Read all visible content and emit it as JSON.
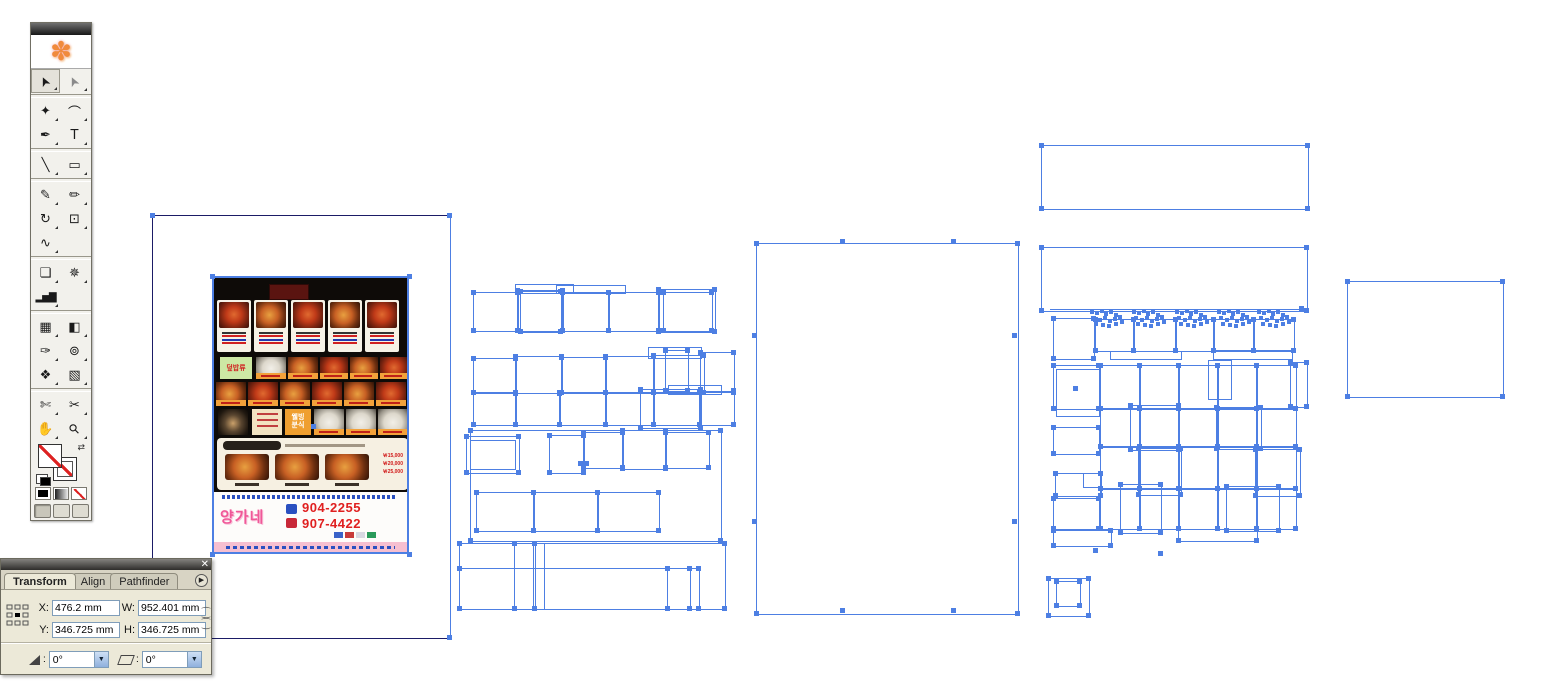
{
  "colors": {
    "selection": "#4d7fe3",
    "artboard_line": "#1b1b66"
  },
  "toolbar": {
    "tools": [
      {
        "name": "selection-tool",
        "glyph": "➤"
      },
      {
        "name": "direct-selection-tool",
        "glyph": "➤"
      },
      {
        "name": "magic-wand-tool",
        "glyph": "✦"
      },
      {
        "name": "lasso-tool",
        "glyph": "⌒"
      },
      {
        "name": "pen-tool",
        "glyph": "✒"
      },
      {
        "name": "type-tool",
        "glyph": "T"
      },
      {
        "name": "line-segment-tool",
        "glyph": "╲"
      },
      {
        "name": "rectangle-tool",
        "glyph": "▭"
      },
      {
        "name": "paintbrush-tool",
        "glyph": "✎"
      },
      {
        "name": "pencil-tool",
        "glyph": "✏"
      },
      {
        "name": "rotate-tool",
        "glyph": "↻"
      },
      {
        "name": "scale-tool",
        "glyph": "⊡"
      },
      {
        "name": "warp-tool",
        "glyph": "∿"
      },
      {
        "name": "free-transform-tool",
        "glyph": "❏"
      },
      {
        "name": "symbol-sprayer-tool",
        "glyph": "✵"
      },
      {
        "name": "graph-tool",
        "glyph": "▂▅▇"
      },
      {
        "name": "mesh-tool",
        "glyph": "▦"
      },
      {
        "name": "gradient-tool",
        "glyph": "◧"
      },
      {
        "name": "eyedropper-tool",
        "glyph": "✑"
      },
      {
        "name": "blend-tool",
        "glyph": "⊚"
      },
      {
        "name": "live-paint-bucket-tool",
        "glyph": "❖"
      },
      {
        "name": "live-paint-selection-tool",
        "glyph": "▧"
      },
      {
        "name": "slice-tool",
        "glyph": "✄"
      },
      {
        "name": "scissors-tool",
        "glyph": "✂"
      },
      {
        "name": "hand-tool",
        "glyph": "✋"
      },
      {
        "name": "zoom-tool",
        "glyph": "⚲"
      }
    ]
  },
  "transform_panel": {
    "tabs": [
      {
        "label": "Transform"
      },
      {
        "label": "Align"
      },
      {
        "label": "Pathfinder"
      }
    ],
    "active_tab": "Transform",
    "close_glyph": "✕",
    "menu_glyph": "▶",
    "fields": {
      "x_label": "X:",
      "x_value": "476.2 mm",
      "y_label": "Y:",
      "y_value": "346.725 mm",
      "w_label": "W:",
      "w_value": "952.401 mm",
      "h_label": "H:",
      "h_value": "346.725 mm"
    },
    "rotate_value": "0°",
    "shear_value": "0°",
    "dropdown_glyph": "▼"
  },
  "menu_flyer": {
    "category_label": "덮밥류",
    "wellbeing_line1": "웰빙",
    "wellbeing_line2": "분식",
    "brand": "양가네",
    "phone1": "904-2255",
    "phone2": "907-4422",
    "prices": [
      "￦15,000",
      "￦20,000",
      "￦25,000"
    ]
  },
  "selection": {
    "artboard": {
      "x": 152,
      "y": 215,
      "w": 297,
      "h": 422
    },
    "image": {
      "x": 212,
      "y": 276,
      "w": 197,
      "h": 278
    },
    "groups": {
      "center": [
        [
          473,
          292,
          44,
          38
        ],
        [
          517,
          290,
          45,
          40
        ],
        [
          562,
          292,
          46,
          38
        ],
        [
          608,
          292,
          50,
          38
        ],
        [
          658,
          289,
          56,
          42
        ],
        [
          520,
          291,
          40,
          40
        ],
        [
          663,
          292,
          48,
          38
        ],
        [
          515,
          284,
          57,
          8,
          0
        ],
        [
          556,
          285,
          68,
          7,
          0
        ],
        [
          473,
          358,
          42,
          34
        ],
        [
          515,
          356,
          46,
          36
        ],
        [
          561,
          357,
          44,
          35
        ],
        [
          605,
          356,
          48,
          36
        ],
        [
          653,
          355,
          50,
          37
        ],
        [
          665,
          350,
          22,
          40
        ],
        [
          700,
          352,
          33,
          38
        ],
        [
          668,
          385,
          52,
          8,
          0
        ],
        [
          648,
          347,
          52,
          10,
          0
        ],
        [
          473,
          392,
          42,
          32
        ],
        [
          515,
          393,
          44,
          31
        ],
        [
          559,
          392,
          46,
          32
        ],
        [
          605,
          392,
          48,
          32
        ],
        [
          653,
          392,
          46,
          32
        ],
        [
          699,
          392,
          34,
          32
        ],
        [
          640,
          389,
          60,
          38
        ],
        [
          466,
          436,
          52,
          36
        ],
        [
          470,
          440,
          44,
          28,
          0
        ],
        [
          549,
          435,
          34,
          37
        ],
        [
          583,
          432,
          39,
          35
        ],
        [
          622,
          430,
          43,
          38
        ],
        [
          665,
          432,
          43,
          35
        ],
        [
          470,
          430,
          250,
          110
        ],
        [
          476,
          492,
          57,
          38
        ],
        [
          533,
          492,
          64,
          38
        ],
        [
          597,
          492,
          61,
          38
        ],
        [
          459,
          543,
          265,
          65
        ],
        [
          514,
          543,
          20,
          65
        ],
        [
          533,
          543,
          10,
          65,
          0
        ],
        [
          459,
          568,
          239,
          40
        ],
        [
          667,
          568,
          22,
          40
        ]
      ],
      "big": [
        [
          756,
          243,
          261,
          370
        ]
      ],
      "top_right": [
        [
          1041,
          145,
          266,
          63
        ],
        [
          1041,
          247,
          265,
          63
        ]
      ],
      "right_grid": [
        [
          1053,
          318,
          40,
          40
        ],
        [
          1053,
          365,
          45,
          43
        ],
        [
          1056,
          369,
          42,
          46,
          0
        ],
        [
          1053,
          427,
          45,
          26
        ],
        [
          1055,
          473,
          45,
          22
        ],
        [
          1083,
          473,
          17,
          13,
          0
        ],
        [
          1053,
          498,
          45,
          30
        ],
        [
          1053,
          530,
          57,
          15
        ],
        [
          1095,
          319,
          38,
          31
        ],
        [
          1133,
          319,
          42,
          31
        ],
        [
          1175,
          319,
          38,
          31
        ],
        [
          1213,
          319,
          40,
          31
        ],
        [
          1253,
          319,
          40,
          31
        ],
        [
          1110,
          351,
          70,
          7,
          0
        ],
        [
          1213,
          350,
          78,
          8,
          0
        ],
        [
          1100,
          365,
          39,
          43
        ],
        [
          1139,
          365,
          39,
          43
        ],
        [
          1178,
          365,
          39,
          43
        ],
        [
          1217,
          365,
          39,
          43
        ],
        [
          1256,
          365,
          39,
          43
        ],
        [
          1100,
          408,
          39,
          38
        ],
        [
          1139,
          408,
          39,
          38
        ],
        [
          1178,
          408,
          39,
          38
        ],
        [
          1217,
          408,
          39,
          38
        ],
        [
          1256,
          408,
          39,
          38
        ],
        [
          1100,
          446,
          39,
          42
        ],
        [
          1139,
          446,
          39,
          42
        ],
        [
          1178,
          446,
          39,
          42
        ],
        [
          1217,
          446,
          39,
          42
        ],
        [
          1256,
          446,
          39,
          42
        ],
        [
          1100,
          488,
          39,
          40
        ],
        [
          1139,
          488,
          39,
          40
        ],
        [
          1178,
          488,
          39,
          40
        ],
        [
          1217,
          488,
          39,
          40
        ],
        [
          1256,
          488,
          39,
          40
        ],
        [
          1208,
          360,
          22,
          38,
          0
        ],
        [
          1290,
          362,
          16,
          44
        ],
        [
          1130,
          405,
          48,
          44
        ],
        [
          1216,
          407,
          44,
          41
        ],
        [
          1138,
          448,
          42,
          46
        ],
        [
          1255,
          449,
          44,
          46
        ],
        [
          1226,
          486,
          52,
          44
        ],
        [
          1120,
          484,
          40,
          48
        ],
        [
          1178,
          488,
          78,
          52
        ]
      ],
      "far_right": [
        [
          1347,
          281,
          155,
          115
        ]
      ],
      "small_pair": [
        [
          1048,
          578,
          40,
          37
        ],
        [
          1056,
          581,
          23,
          24
        ]
      ]
    },
    "lines": [
      [
        1050,
        309,
        253
      ]
    ],
    "blobs": [
      [
        1090,
        310
      ],
      [
        1132,
        310
      ],
      [
        1175,
        310
      ],
      [
        1217,
        310
      ],
      [
        1257,
        310
      ]
    ],
    "extra_handles": [
      [
        313,
        426
      ],
      [
        580,
        463
      ],
      [
        586,
        463
      ],
      [
        1075,
        388
      ],
      [
        842,
        241
      ],
      [
        953,
        241
      ],
      [
        754,
        335
      ],
      [
        754,
        521
      ],
      [
        1014,
        335
      ],
      [
        1014,
        521
      ],
      [
        842,
        610
      ],
      [
        953,
        610
      ],
      [
        1301,
        308
      ],
      [
        1095,
        550
      ],
      [
        1160,
        553
      ]
    ]
  }
}
